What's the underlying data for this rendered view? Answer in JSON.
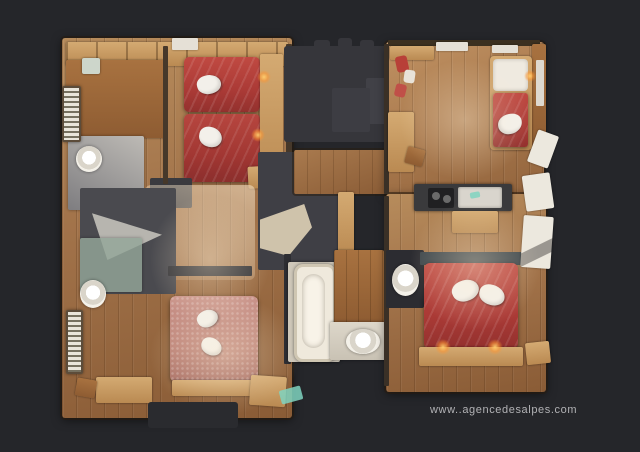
{
  "scene": {
    "type": "3d-dollhouse-floor-plan-scan",
    "background_color": "#25262a",
    "rooms": [
      "twin-bedroom-top-left",
      "bathroom-top-left",
      "shower-room-mid-left",
      "double-bedroom-bottom-left",
      "entry-hall-center",
      "bathroom-center",
      "living-kitchen-top-right",
      "double-bedroom-bottom-right",
      "wc-right",
      "balcony-left-top",
      "balcony-left-bottom"
    ],
    "furniture": [
      "twin-bed",
      "twin-bed",
      "double-bed-pink",
      "double-bed-red",
      "sofa-daybed-red",
      "bathtub",
      "toilet",
      "toilet",
      "washbasin",
      "kitchen-counter-cooktop-sink",
      "desk",
      "desk",
      "towel-swan",
      "towel-swan",
      "towel-swan",
      "towel-swan",
      "towel-swan",
      "towel-swan",
      "bedside-lamp-glow",
      "bedside-lamp-glow",
      "bedside-lamp-glow",
      "bedside-lamp-glow"
    ]
  },
  "watermark": {
    "text": "www..agencedesalpes.com",
    "color": "#b2b2b5"
  },
  "palette": {
    "background": "#25262a",
    "wood_floor": "#a2734a",
    "wood_light": "#c89a62",
    "bed_red": "#ab3a36",
    "bed_pink": "#bc8176",
    "towel_white": "#f3f0ea",
    "bathroom_gray": "#9a9895",
    "glass_green": "#94a699",
    "ghost_gray": "#36363b",
    "dark_room": "#3f3f45",
    "lamp_glow": "#ffb95c",
    "teal_accent": "#7fd4c0"
  }
}
